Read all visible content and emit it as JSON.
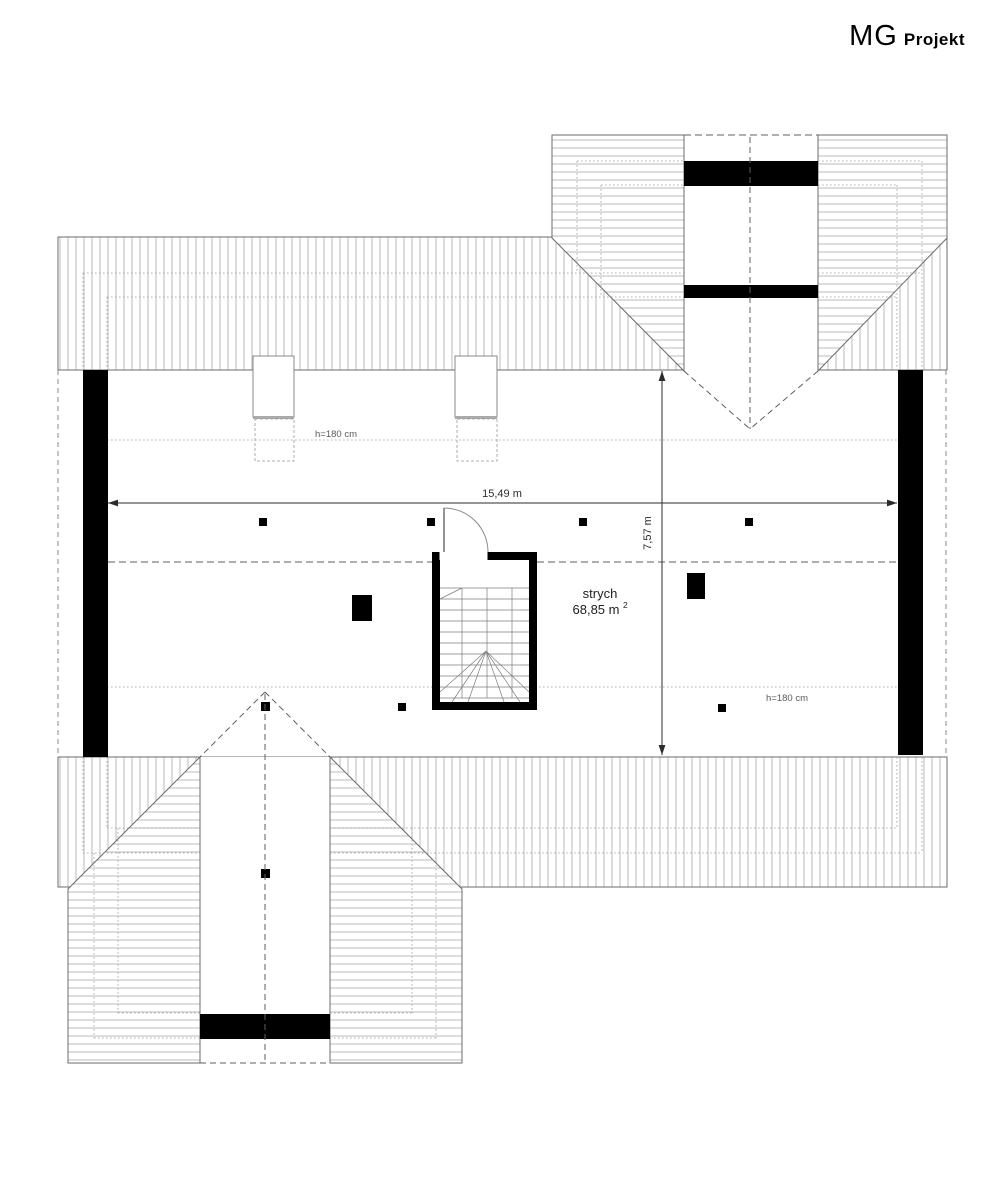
{
  "logo": {
    "brand": "MG",
    "suffix": "Projekt"
  },
  "labels": {
    "room": "strych",
    "area": "68,85 m",
    "area_sup": "2",
    "width": "15,49 m",
    "depth": "7,57 m",
    "knee_top": "h=180 cm",
    "knee_bottom": "h=180 cm"
  },
  "colors": {
    "outline": "#6b6b6b",
    "hatch": "#b3b3b3",
    "wall": "#000000",
    "dimension": "#2b2b2b",
    "background": "#ffffff"
  }
}
